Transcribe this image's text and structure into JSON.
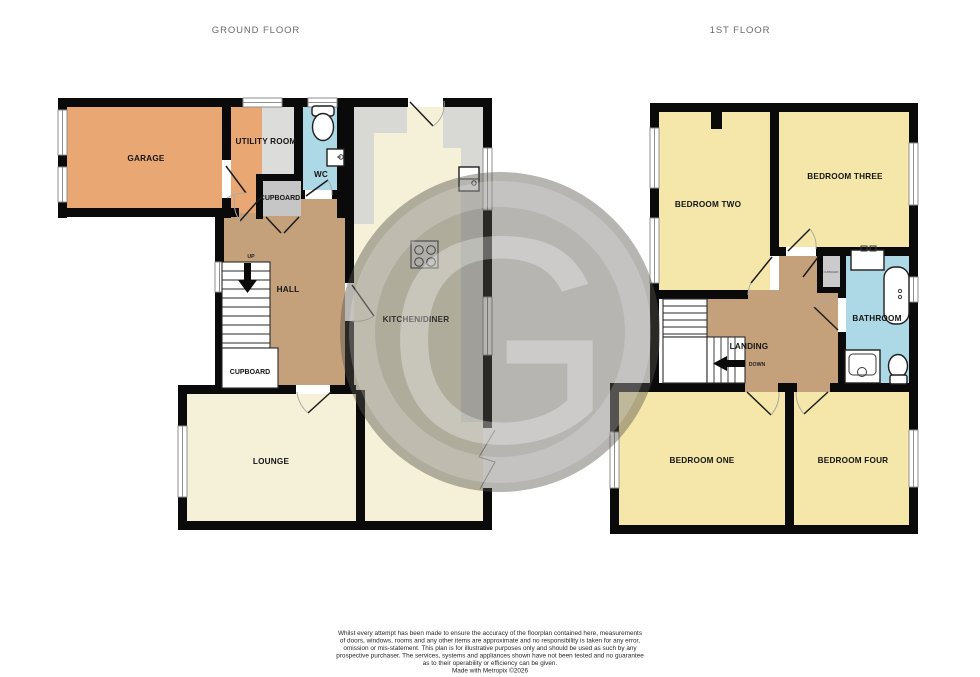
{
  "titles": {
    "ground": "GROUND FLOOR",
    "first": "1ST FLOOR"
  },
  "rooms": {
    "garage": "GARAGE",
    "utility_room": "UTILITY ROOM",
    "wc": "WC",
    "cupboard_hall_top": "CUPBOARD",
    "hall": "HALL",
    "cupboard_under_stairs": "CUPBOARD",
    "kitchen_diner": "KITCHEN/DINER",
    "lounge": "LOUNGE",
    "bedroom_one": "BEDROOM ONE",
    "bedroom_two": "BEDROOM TWO",
    "bedroom_three": "BEDROOM THREE",
    "bedroom_four": "BEDROOM FOUR",
    "bathroom": "BATHROOM",
    "landing": "LANDING",
    "airing_cupboard": "CUPBOARD"
  },
  "stairs": {
    "up": "UP",
    "down": "DOWN"
  },
  "watermark": {
    "letter": "G"
  },
  "colors": {
    "room_orange": "#E9A873",
    "room_tan": "#C5A17B",
    "room_cream": "#F5F0D8",
    "room_yellow": "#F5E7A9",
    "room_blue": "#ACD9E5",
    "counter_grey": "#D8D8D4",
    "cupboard_grey": "#C6C6C6",
    "utility_grey": "#DCDCDA",
    "wall_black": "#0A0A0A"
  },
  "disclaimer": {
    "lines": [
      "Whilst every attempt has been made to ensure the accuracy of the floorplan contained here, measurements",
      "of doors, windows, rooms and any other items are approximate and no responsibility is taken for any error,",
      "omission or mis-statement. This plan is for illustrative purposes only and should be used as such by any",
      "prospective purchaser. The services, systems and appliances shown have not been tested and no guarantee",
      "as to their operability or efficiency can be given.",
      "Made with Metropix ©2026"
    ]
  }
}
